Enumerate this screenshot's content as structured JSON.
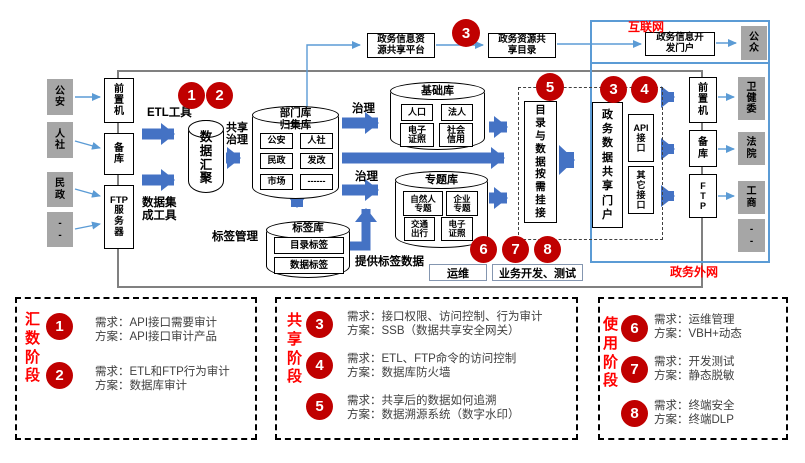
{
  "colors": {
    "accent_blue": "#4472c4",
    "light_blue": "#5b9bd5",
    "badge_red": "#c00000",
    "label_red": "#ff0000",
    "gray_box": "#a6a6a6"
  },
  "badges": {
    "b1": "1",
    "b2": "2",
    "b3": "3",
    "b4": "4",
    "b5": "5",
    "b6": "6",
    "b7": "7",
    "b8": "8"
  },
  "flow": {
    "sources": [
      "公\n安",
      "人\n社",
      "民\n政",
      "-\n-"
    ],
    "gateways_left": [
      "前\n置\n机",
      "备\n库",
      "FTP\n服\n务\n器"
    ],
    "etl_label": "ETL工具",
    "integration_label": "数据集\n成工具",
    "aggregation_db": "数\n据\n汇\n聚",
    "share_governance": "共享\n治理",
    "governance": "治理",
    "dept_db_title": "部门库\n归集库",
    "dept_cells": [
      "公安",
      "人社",
      "民政",
      "发改",
      "市场",
      "------"
    ],
    "base_db_title": "基础库",
    "base_cells": [
      "人口",
      "法人",
      "电子\n证照",
      "社会\n信用"
    ],
    "topic_db_title": "专题库",
    "topic_cells": [
      "自然人\n专题",
      "企业\n专题",
      "交通\n出行",
      "电子\n证照"
    ],
    "tag_db_title": "标签库",
    "tag_cells": [
      "目录标签",
      "数据标签"
    ],
    "tag_mgmt": "标签管理",
    "provide_tags": "提供标签数据",
    "platform_box": "政务信息资\n源共享平台",
    "catalog_box": "政务资源共\n享目录",
    "dev_portal": "政务信息开\n发门户",
    "public_box": "公\n众",
    "internet_label": "互联网",
    "extranet_label": "政务外网",
    "mount_box": "目\n录\n与\n数\n据\n按\n需\n挂\n接",
    "share_portal": "政\n务\n数\n据\n共\n享\n门\n户",
    "api_box": "API\n接\n口",
    "other_api_box": "其\n它\n接\n口",
    "gateways_right": [
      "前\n置\n机",
      "备\n库",
      "F\nT\nP"
    ],
    "consumers": [
      "卫\n健\n委",
      "法\n院",
      "工\n商",
      "-\n-"
    ],
    "ops_box": "运维",
    "dev_test_box": "业务开发、测试"
  },
  "legend": {
    "sections": [
      {
        "title": "汇\n数\n阶\n段",
        "items": [
          {
            "num": "1",
            "req": "需求：API接口需要审计",
            "sol": "方案：API接口审计产品"
          },
          {
            "num": "2",
            "req": "需求：ETL和FTP行为审计",
            "sol": "方案：数据库审计"
          }
        ]
      },
      {
        "title": "共\n享\n阶\n段",
        "items": [
          {
            "num": "3",
            "req": "需求：接口权限、访问控制、行为审计",
            "sol": "方案：SSB（数据共享安全网关）"
          },
          {
            "num": "4",
            "req": "需求：ETL、FTP命令的访问控制",
            "sol": "方案：数据库防火墙"
          },
          {
            "num": "5",
            "req": "需求：共享后的数据如何追溯",
            "sol": "方案：数据溯源系统（数字水印）"
          }
        ]
      },
      {
        "title": "使\n用\n阶\n段",
        "items": [
          {
            "num": "6",
            "req": "需求：运维管理",
            "sol": "方案：VBH+动态"
          },
          {
            "num": "7",
            "req": "需求：开发测试",
            "sol": "方案：静态脱敏"
          },
          {
            "num": "8",
            "req": "需求：终端安全",
            "sol": "方案：终端DLP"
          }
        ]
      }
    ]
  }
}
